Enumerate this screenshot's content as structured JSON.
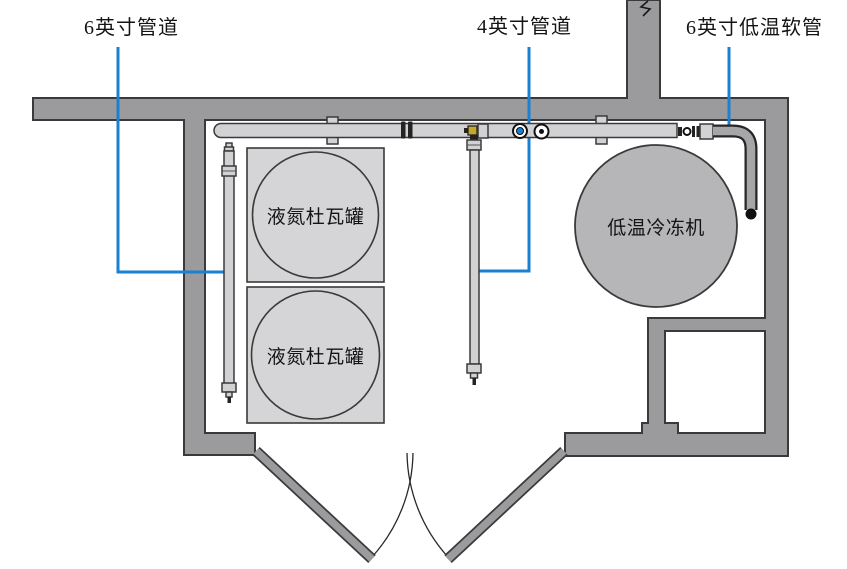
{
  "figure": {
    "title": "低温设备管道布置示意图",
    "callouts": [
      {
        "id": "pipe6",
        "text": "6英寸管道"
      },
      {
        "id": "pipe4",
        "text": "4英寸管道"
      },
      {
        "id": "hose6",
        "text": "6英寸低温软管"
      }
    ],
    "equipment": {
      "dewar1": "液氮杜瓦罐",
      "dewar2": "液氮杜瓦罐",
      "chiller": "低温冷冻机"
    }
  },
  "colors": {
    "wall_gray": "#9b9b9d",
    "outline": "#3a3a3a",
    "pipe_gray": "#d2d2d4",
    "equipment_light_gray": "#d5d5d7",
    "chiller_gray": "#b6b6b8",
    "hose_gray": "#a6a6a8",
    "leader_blue": "#1a80d2",
    "valve_yellow": "#c7a62c"
  }
}
